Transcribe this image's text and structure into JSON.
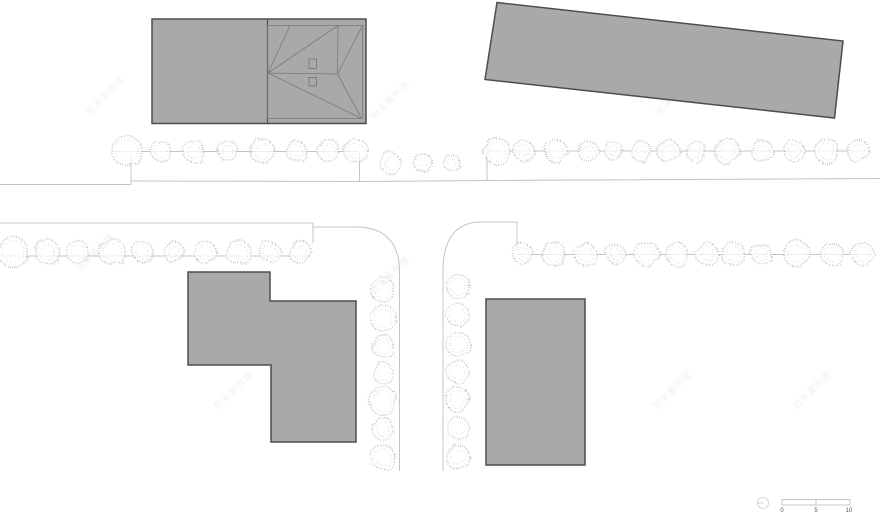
{
  "canvas": {
    "w": 880,
    "h": 519,
    "bg": "#ffffff"
  },
  "colors": {
    "building_fill": "#a9a9a9",
    "building_stroke": "#4d4d4d",
    "divider_stroke": "#555555",
    "roof_line": "#7a7a7a",
    "road_line": "#c4c4c4",
    "tree_stroke": "#c2c2c2",
    "tree_inner_stroke": "#d5d5d5",
    "tree_fill": "rgba(255,255,255,0.75)",
    "scale_stroke": "#c7c7c7",
    "scale_circle_stroke": "#d9d9d9",
    "scale_text": "#555555",
    "watermark_text_color": "#8a8a8a"
  },
  "buildings": [
    {
      "name": "building-northwest",
      "points": [
        [
          152,
          19
        ],
        [
          366,
          19
        ],
        [
          366,
          123.5
        ],
        [
          152,
          123.5
        ]
      ]
    },
    {
      "name": "building-northeast",
      "points": [
        [
          497,
          2.5
        ],
        [
          843,
          41
        ],
        [
          834.5,
          118
        ],
        [
          485,
          79.5
        ]
      ]
    },
    {
      "name": "building-southwest",
      "points": [
        [
          188,
          272
        ],
        [
          270,
          272
        ],
        [
          270,
          301
        ],
        [
          356,
          301
        ],
        [
          356,
          442
        ],
        [
          271,
          442
        ],
        [
          271,
          365
        ],
        [
          188,
          365
        ]
      ]
    },
    {
      "name": "building-southeast",
      "points": [
        [
          486,
          299
        ],
        [
          585,
          299
        ],
        [
          585,
          465
        ],
        [
          486,
          465
        ]
      ]
    }
  ],
  "building_nw_details": {
    "divider": [
      [
        267.5,
        19
      ],
      [
        267.5,
        123.5
      ]
    ],
    "inner_outline": [
      [
        267.5,
        25.5
      ],
      [
        362.5,
        25.5
      ],
      [
        362.5,
        118.5
      ],
      [
        267.5,
        118.5
      ],
      [
        267.5,
        25.5
      ]
    ],
    "roof_lines": [
      [
        [
          268,
          73
        ],
        [
          337.5,
          74
        ]
      ],
      [
        [
          268,
          73
        ],
        [
          290,
          25.5
        ]
      ],
      [
        [
          268,
          73
        ],
        [
          338,
          25.5
        ]
      ],
      [
        [
          268,
          73
        ],
        [
          361.5,
          118.5
        ]
      ],
      [
        [
          337.5,
          74
        ],
        [
          338,
          25.5
        ]
      ],
      [
        [
          337.5,
          74
        ],
        [
          362.5,
          25.5
        ]
      ],
      [
        [
          337.5,
          74
        ],
        [
          361.5,
          118.5
        ]
      ]
    ],
    "rooflights": [
      [
        309,
        59,
        7.5,
        9.5
      ],
      [
        309,
        77.5,
        7.5,
        8.5
      ]
    ]
  },
  "roads": [
    {
      "name": "street-north-edge",
      "d": "M 0 184.5 H 131 M 131 181 L 360 181.5 L 487 180.5 L 880 178.5"
    },
    {
      "name": "boundary-stub-west",
      "d": "M 131 153 V 184.5"
    },
    {
      "name": "boundary-stub-midwest",
      "d": "M 359.5 152 V 181.5"
    },
    {
      "name": "boundary-stub-mideast",
      "d": "M 487 152 V 180.5"
    },
    {
      "name": "street-south-edge-west",
      "d": "M 0 223 H 313 V 243 M 313 227 H 357 Q 399.5 228 399.5 272 V 471"
    },
    {
      "name": "street-south-edge-east",
      "d": "M 517 222 H 480 Q 443 223 443 271.5 V 471 M 517 222 V 252"
    },
    {
      "name": "tree-line-row1-west",
      "d": "M 112 151.5 H 358"
    },
    {
      "name": "tree-line-row1-east",
      "d": "M 487 151 H 866"
    },
    {
      "name": "tree-line-row2-west",
      "d": "M 0 256 H 310"
    },
    {
      "name": "tree-line-row2-east",
      "d": "M 517 254.5 H 871"
    }
  ],
  "tree_rows": [
    {
      "name": "tree-row-north-west",
      "axis": "x",
      "fixed": 151,
      "trees": [
        [
          127,
          15
        ],
        [
          161,
          10
        ],
        [
          194,
          11
        ],
        [
          228,
          10
        ],
        [
          262,
          12
        ],
        [
          296,
          10
        ],
        [
          329,
          11
        ],
        [
          356,
          12
        ]
      ]
    },
    {
      "name": "tree-row-north-mid",
      "axis": "x",
      "fixed": 163,
      "trees": [
        [
          390,
          10
        ],
        [
          423,
          9
        ],
        [
          452,
          8
        ]
      ]
    },
    {
      "name": "tree-row-north-east",
      "axis": "x",
      "fixed": 151,
      "trees": [
        [
          497,
          13
        ],
        [
          524,
          10
        ],
        [
          556,
          11
        ],
        [
          588,
          10
        ],
        [
          614,
          9
        ],
        [
          641,
          10
        ],
        [
          668,
          11
        ],
        [
          696,
          10
        ],
        [
          727,
          13
        ],
        [
          762,
          11
        ],
        [
          794,
          10
        ],
        [
          827,
          12
        ],
        [
          858,
          11
        ]
      ]
    },
    {
      "name": "tree-row-south-west",
      "axis": "x",
      "fixed": 252,
      "trees": [
        [
          13,
          15
        ],
        [
          47,
          12
        ],
        [
          78,
          11
        ],
        [
          112,
          13
        ],
        [
          143,
          10
        ],
        [
          174,
          10
        ],
        [
          205,
          11
        ],
        [
          238,
          12
        ],
        [
          270,
          10
        ],
        [
          300,
          11
        ]
      ]
    },
    {
      "name": "tree-row-south-east",
      "axis": "x",
      "fixed": 254,
      "trees": [
        [
          523,
          10
        ],
        [
          554,
          12
        ],
        [
          585,
          11
        ],
        [
          616,
          9
        ],
        [
          647,
          12
        ],
        [
          677,
          11
        ],
        [
          707,
          11
        ],
        [
          733,
          12
        ],
        [
          762,
          10
        ],
        [
          797,
          13
        ],
        [
          832,
          11
        ],
        [
          863,
          11
        ]
      ]
    },
    {
      "name": "tree-column-west",
      "axis": "y",
      "fixed": 383,
      "trees": [
        [
          290,
          12
        ],
        [
          318,
          13
        ],
        [
          346,
          11
        ],
        [
          373,
          10
        ],
        [
          401,
          14
        ],
        [
          429,
          11
        ],
        [
          457,
          12
        ]
      ]
    },
    {
      "name": "tree-column-east",
      "axis": "y",
      "fixed": 458,
      "trees": [
        [
          286,
          12
        ],
        [
          315,
          11
        ],
        [
          344,
          12
        ],
        [
          372,
          11
        ],
        [
          400,
          12
        ],
        [
          428,
          11
        ],
        [
          457,
          12
        ]
      ]
    }
  ],
  "scalebar": {
    "labels": [
      "0",
      "5",
      "10"
    ],
    "label_x": [
      782,
      816,
      849
    ],
    "label_y": 508,
    "circle": {
      "cx": 763,
      "cy": 503,
      "r": 5.5
    },
    "bar": {
      "x": 782,
      "y": 499.5,
      "w": 68,
      "h": 5.5,
      "mid": 816
    }
  },
  "watermark": {
    "text": "知末案例馆",
    "positions": [
      [
        105,
        95
      ],
      [
        390,
        100
      ],
      [
        675,
        95
      ],
      [
        95,
        252
      ],
      [
        390,
        275
      ],
      [
        233,
        390
      ],
      [
        530,
        390
      ],
      [
        672,
        390
      ],
      [
        812,
        390
      ]
    ]
  }
}
